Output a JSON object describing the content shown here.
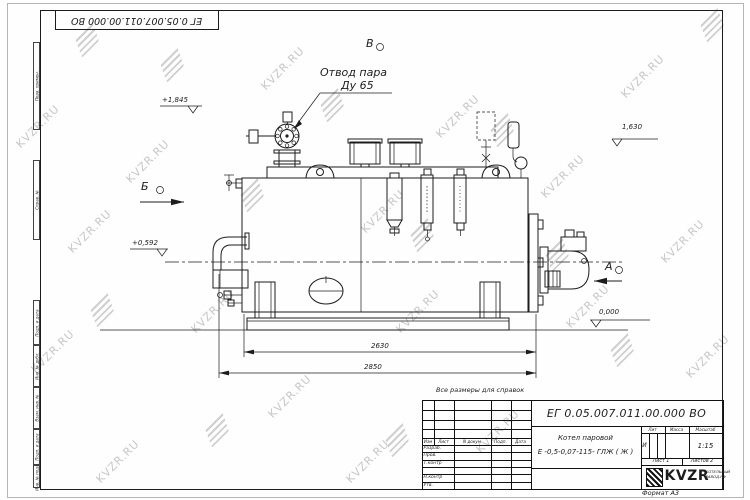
{
  "watermark": {
    "text": "KVZR.RU"
  },
  "doc": {
    "number": "ЕГ 0.05.007.011.00.000  ВО",
    "format_label": "Формат А3",
    "reference_note": "Все размеры для справок"
  },
  "margin_labels": [
    "Перв. примен.",
    "Справ. №",
    "Подп. и дата",
    "Инв. № дубл.",
    "Взам. инв. №",
    "Подп. и дата",
    "Инв. № подл."
  ],
  "drawing": {
    "callout_line1": "Отвод пара",
    "callout_line2": "Ду 65",
    "view_b": "Б",
    "view_v": "В",
    "view_a": "А",
    "elev_valve_top": "+1,845",
    "elev_boiler_top": "1,630",
    "elev_burner_axis": "+0,592",
    "elev_zero": "0,000",
    "dim_boiler_length": "2630",
    "dim_overall_length": "2850"
  },
  "title_block": {
    "doc_number": "ЕГ 0.05.007.011.00.000  ВО",
    "product_name_line1": "Котел паровой",
    "product_name_line2": "Е -0,5-0,07-115- ГЛЖ ( Ж )",
    "col_izm": "Изм",
    "col_list": "Лист",
    "col_docnum": "N докум",
    "col_podp": "Подп.",
    "col_data": "Дата",
    "row_razrab": "Разраб.",
    "row_prov": "Пров.",
    "row_tkontr": "Т.контр",
    "row_nkontr": "Н.контр",
    "row_utv": "Утв.",
    "lit_label": "Лит",
    "mass_label": "Масса",
    "scale_label": "Масштаб",
    "lit_value": "И",
    "scale_value": "1:15",
    "sheet_info": "Лист  1",
    "sheets_info": "Листов   2",
    "logo_text": "KVZR",
    "logo_sub_line1": "КОТЕЛЬНЫЙ",
    "logo_sub_line2": "ЗАВОД.РФ"
  }
}
